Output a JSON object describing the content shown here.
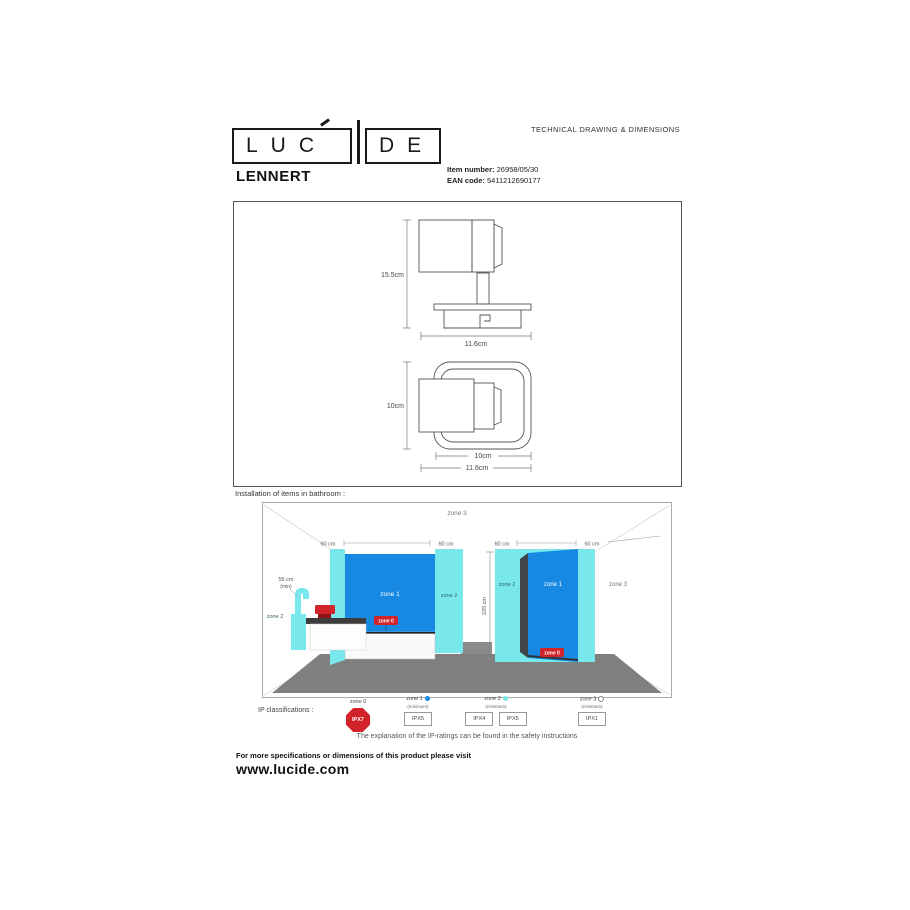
{
  "header": {
    "logo_left": "LUC",
    "logo_right": "DE",
    "doc_type": "TECHNICAL DRAWING & DIMENSIONS"
  },
  "product": {
    "name": "LENNERT",
    "item_label": "Item number:",
    "item_value": "26958/05/30",
    "ean_label": "EAN code:",
    "ean_value": "5411212690177"
  },
  "drawing": {
    "side_height": "15.5cm",
    "side_width": "11.6cm",
    "top_height": "10cm",
    "top_width_inner": "10cm",
    "top_width_outer": "11.6cm"
  },
  "bathroom": {
    "title": "Installation of items in bathroom :",
    "zone3_top": "zone 3",
    "dim1": "60 cm",
    "dim2": "60 cm",
    "dim3": "60 cm",
    "dim4": "60 cm",
    "faucet_dim": "55 cm",
    "faucet_dim_min": "(min)",
    "room_height": "225 cm",
    "tub_zone1": "zone 1",
    "tub_zone2": "zone 2",
    "tub_zone0": "zone 0",
    "faucet_zone2": "zone 2",
    "shower_zone2": "zone 2",
    "shower_zone1": "zone 1",
    "shower_zone0": "zone 0",
    "wall_zone3": "zone 3"
  },
  "legend": {
    "title": "IP classifications :",
    "zone0": {
      "label": "zone 0",
      "rating": "IPX7"
    },
    "zone1": {
      "label": "zone 1",
      "sub": "(minimum)",
      "rating": "IPX5"
    },
    "zone2": {
      "label": "zone 2",
      "sub": "(minimum)",
      "rating1": "IPX4",
      "rating2": "IPX5"
    },
    "zone3": {
      "label": "zone 3",
      "sub": "(minimum)",
      "rating": "IPX1"
    },
    "note": "The explanation of the IP-ratings can be found in the safety instructions"
  },
  "footer": {
    "line1": "For more specifications or dimensions of this product please visit",
    "line2": "www.lucide.com"
  },
  "colors": {
    "zone1_blue": "#1789e3",
    "zone2_cyan": "#79e8ec",
    "zone0_red": "#d2232a",
    "floor_gray": "#808080"
  }
}
